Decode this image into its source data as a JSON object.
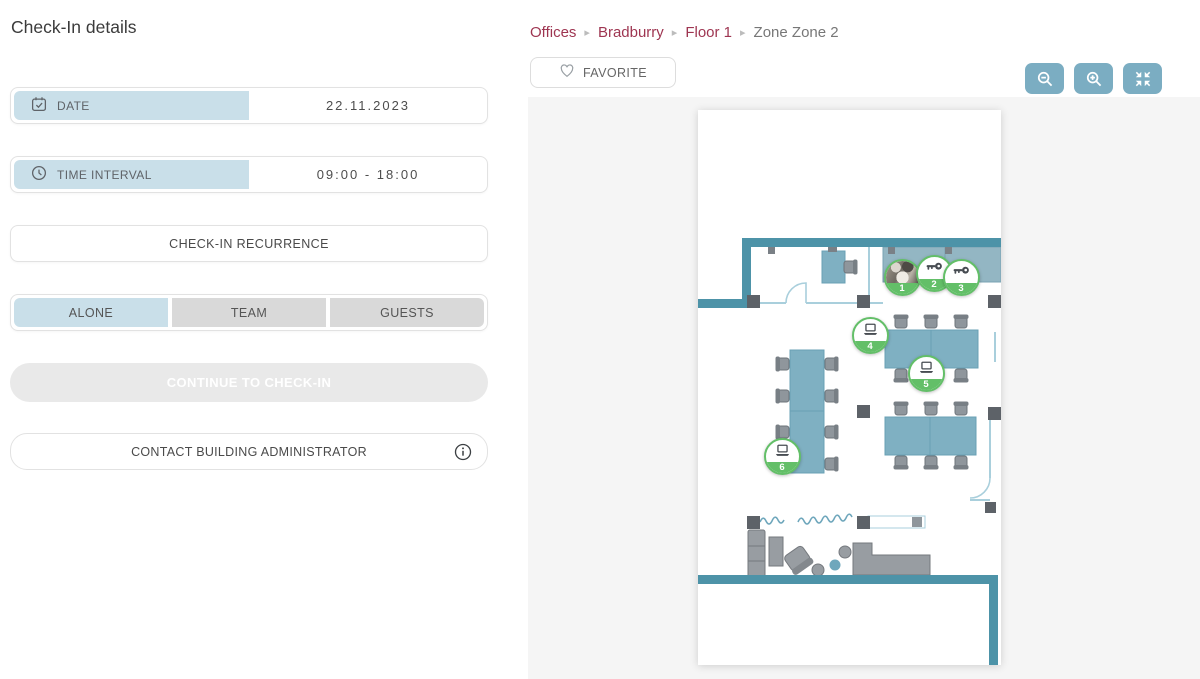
{
  "page": {
    "title": "Check-In details"
  },
  "check_in": {
    "date": {
      "label": "DATE",
      "value": "22.11.2023"
    },
    "time_interval": {
      "label": "TIME INTERVAL",
      "value": "09:00 - 18:00"
    },
    "recurrence_button": "CHECK-IN RECURRENCE",
    "attendance_modes": [
      {
        "label": "ALONE",
        "selected": true
      },
      {
        "label": "TEAM",
        "selected": false
      },
      {
        "label": "GUESTS",
        "selected": false
      }
    ],
    "continue_button": "CONTINUE TO CHECK-IN",
    "contact_button": "CONTACT BUILDING ADMINISTRATOR"
  },
  "breadcrumb": {
    "separator": "▸",
    "items": [
      {
        "label": "Offices",
        "current": false
      },
      {
        "label": "Bradburry",
        "current": false
      },
      {
        "label": "Floor 1",
        "current": false
      },
      {
        "label": "Zone Zone 2",
        "current": true
      }
    ]
  },
  "favorite_button": {
    "label": "FAVORITE"
  },
  "map": {
    "markers": [
      {
        "number": "1",
        "type": "photo-avatar",
        "x": 204,
        "y": 167
      },
      {
        "number": "2",
        "type": "key",
        "x": 236,
        "y": 163
      },
      {
        "number": "3",
        "type": "key",
        "x": 263,
        "y": 167
      },
      {
        "number": "4",
        "type": "laptop",
        "x": 172,
        "y": 225
      },
      {
        "number": "5",
        "type": "laptop",
        "x": 228,
        "y": 263
      },
      {
        "number": "6",
        "type": "laptop",
        "x": 84,
        "y": 346
      }
    ]
  },
  "colors": {
    "accent_blue": "#c9dfe9",
    "wall_teal": "#4d93a8",
    "desk_teal": "#7fb0c2",
    "marker_green": "#63bf68",
    "breadcrumb_link": "#9e3551",
    "zoom_button_blue": "#7badc2",
    "disabled_button": "#e9e9e9"
  }
}
